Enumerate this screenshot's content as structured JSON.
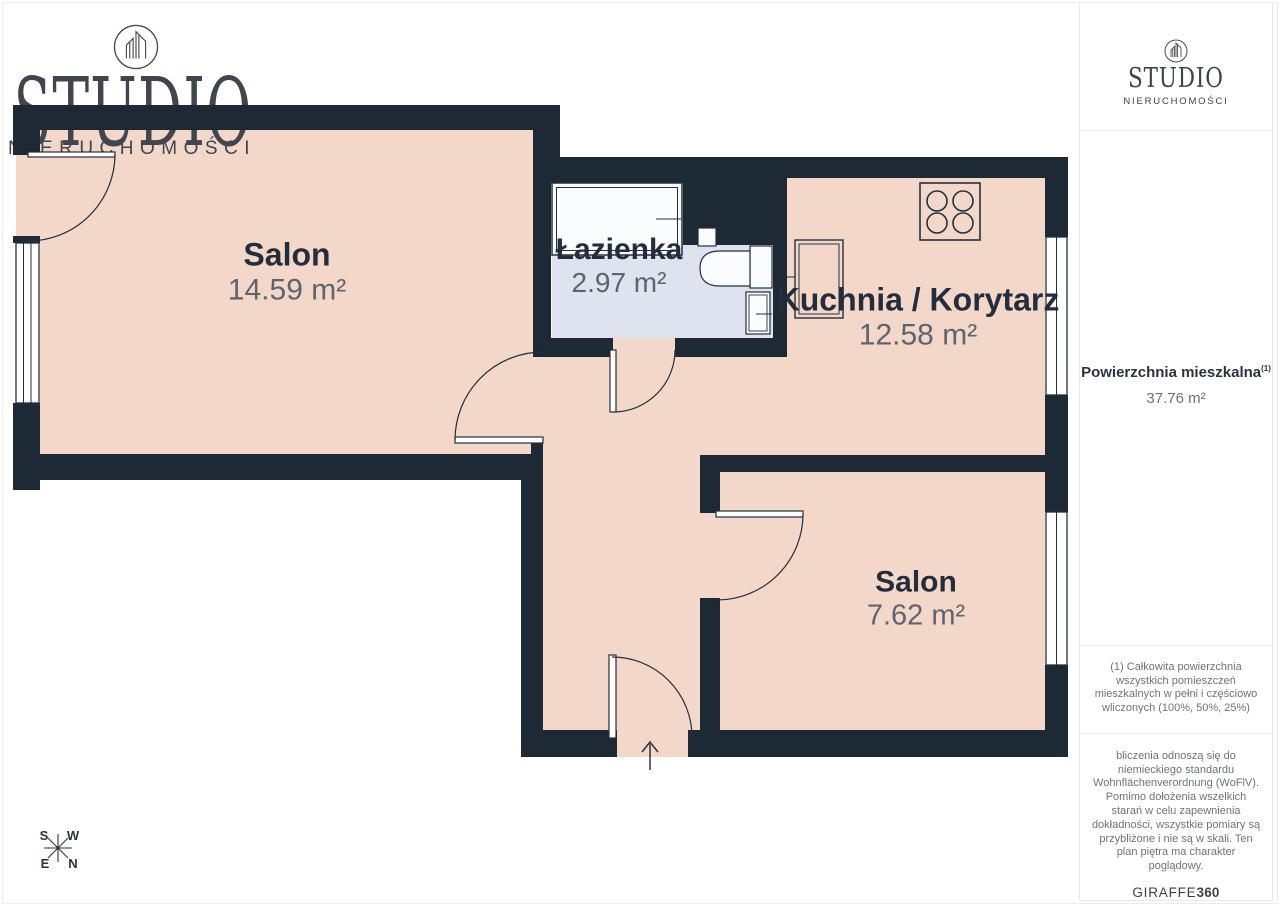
{
  "branding": {
    "logo_title": "STUDIO",
    "logo_subtitle": "NIERUCHOMOŚCI"
  },
  "rooms": [
    {
      "name": "Salon",
      "area": "14.59 m²"
    },
    {
      "name": "Łazienka",
      "area": "2.97 m²"
    },
    {
      "name": "Kuchnia / Korytarz",
      "area": "12.58 m²"
    },
    {
      "name": "Salon",
      "area": "7.62 m²"
    }
  ],
  "sidebar": {
    "summary_title": "Powierzchnia mieszkalna",
    "summary_sup": "(1)",
    "summary_value": "37.76 m²",
    "footnote1": "(1) Całkowita powierzchnia wszystkich pomieszczeń mieszkalnych w pełni i częściowo wliczonych (100%, 50%, 25%)",
    "footnote2": "bliczenia odnoszą się do niemieckiego standardu Wohnflächenverordnung (WoFlV). Pomimo dołożenia wszelkich starań w celu zapewnienia dokładności, wszystkie pomiary są przybliżone i nie są w skali. Ten plan piętra ma charakter poglądowy.",
    "brand_name": "GIRAFFE",
    "brand_number": "360"
  },
  "compass": {
    "top_left": "S",
    "top_right": "W",
    "bottom_left": "E",
    "bottom_right": "N"
  },
  "colors": {
    "wall": "#1d2935",
    "floor": "#f3d8ca",
    "bathroom_floor": "#dee3ef",
    "fixture_fill": "#fbfcfe",
    "line": "#22303f",
    "room_name_text": "#232d3b",
    "room_area_text": "#5d646d",
    "logo_text": "#41464e"
  }
}
